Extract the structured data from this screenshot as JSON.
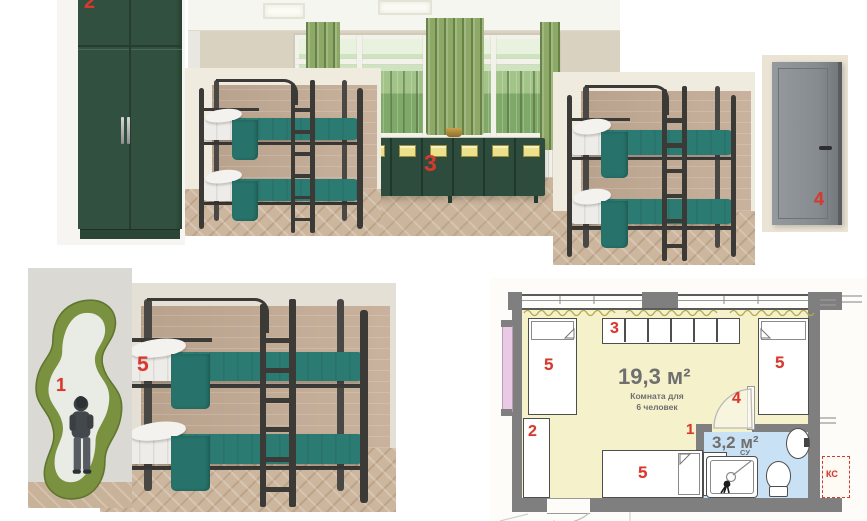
{
  "board": {
    "type": "interior-moodboard",
    "background": "#ffffff"
  },
  "markers": {
    "mirror": "1",
    "wardrobe": "2",
    "lockers": "3",
    "door": "4",
    "bed": "5"
  },
  "floor_plan": {
    "room_area": "19,3 м²",
    "room_caption_line1": "Комната для",
    "room_caption_line2": "6 человек",
    "bath_area": "3,2 м²",
    "bath_label": "СУ",
    "shaft_label": "КС"
  },
  "colors": {
    "marker_red": "#d6392e",
    "wardrobe_green": "#31503f",
    "locker_green": "#2d4c3e",
    "bedding_teal": "#2c7b73",
    "curtain_green": "#8ea868",
    "plan_room_fill": "#f4f1cb",
    "plan_bath_fill": "#c8e1f4",
    "plan_wall_gray": "#7f7f7f",
    "mirror_frame_olive": "#7a9140"
  }
}
